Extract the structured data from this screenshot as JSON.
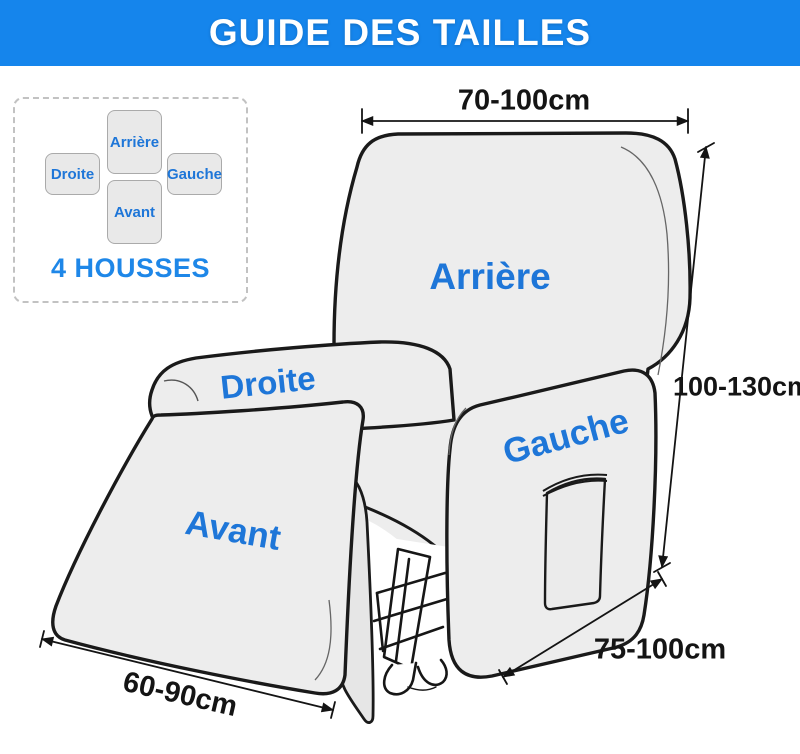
{
  "header": {
    "title": "GUIDE DES TAILLES"
  },
  "legend": {
    "caption": "4 HOUSSES",
    "pieces": {
      "back": "Arrière",
      "right": "Droite",
      "left": "Gauche",
      "front": "Avant"
    }
  },
  "chair": {
    "labels": {
      "back": "Arrière",
      "right_armrest": "Droite",
      "left_armrest": "Gauche",
      "footrest": "Avant"
    }
  },
  "dimensions": {
    "backrest_width": "70-100cm",
    "height": "100-130cm",
    "depth": "75-100cm",
    "footrest_width": "60-90cm"
  },
  "colors": {
    "header_bg": "#1585EC",
    "header_text": "#FFFFFF",
    "label_blue": "#1E76D8",
    "legend_caption_blue": "#1E87E8",
    "chair_fill": "#EDEDED",
    "outline": "#1A1A1A",
    "dimension_text": "#141414"
  }
}
